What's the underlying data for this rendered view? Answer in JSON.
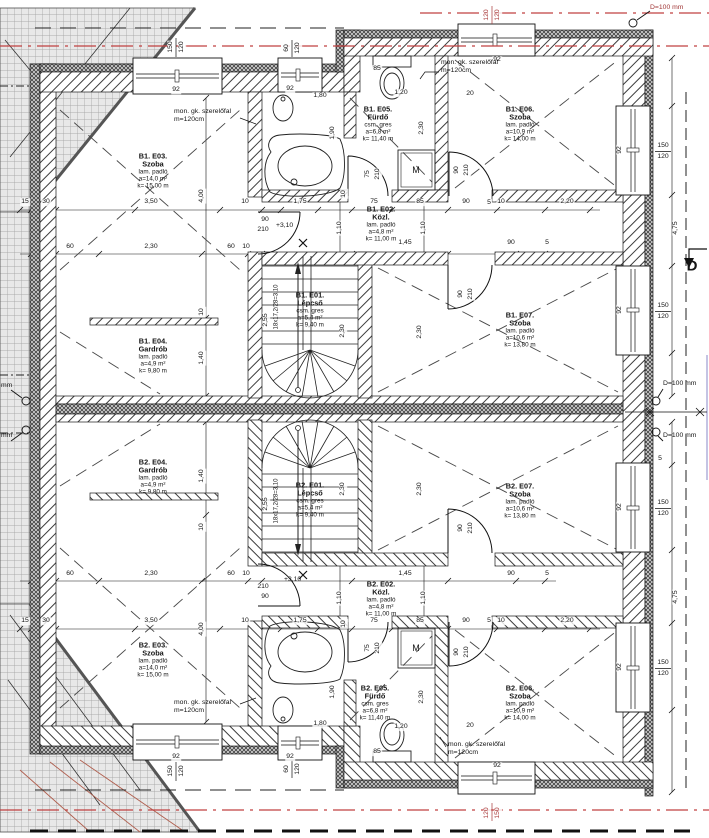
{
  "colors": {
    "red_line": "#c04040",
    "dim_red": "#a83838",
    "blue": "#8a8ac8",
    "ink": "#141414"
  },
  "rooms": [
    {
      "id": "b1-e03",
      "cx": 153,
      "cy": 171,
      "lines": [
        "B1. E03.",
        "Szoba",
        "lam. padló",
        "a=14,0 m²",
        "k= 15,00 m"
      ]
    },
    {
      "id": "b1-e04",
      "cx": 153,
      "cy": 356,
      "lines": [
        "B1. E04.",
        "Gardrób",
        "lam. padló",
        "a=4,9 m²",
        "k= 9,80 m"
      ]
    },
    {
      "id": "b1-e05",
      "cx": 378,
      "cy": 124,
      "lines": [
        "B1. E05.",
        "Fürdő",
        "csm. gres",
        "a=6,8 m²",
        "k= 11,40 m"
      ]
    },
    {
      "id": "b1-e06",
      "cx": 520,
      "cy": 124,
      "lines": [
        "B1. E06.",
        "Szoba",
        "lam. padló",
        "a=10,9 m²",
        "k= 14,00 m"
      ]
    },
    {
      "id": "b1-e02",
      "cx": 381,
      "cy": 224,
      "lines": [
        "B1. E02.",
        "Közl.",
        "lam. padló",
        "a=4,8 m²",
        "k= 11,00 m"
      ]
    },
    {
      "id": "b1-e01",
      "cx": 310,
      "cy": 310,
      "lines": [
        "B1. E01.",
        "Lépcső",
        "csm. gres",
        "a=5,4 m²",
        "k= 9,40 m"
      ]
    },
    {
      "id": "b1-e07",
      "cx": 520,
      "cy": 330,
      "lines": [
        "B1. E07.",
        "Szoba",
        "lam. padló",
        "a=10,6 m²",
        "k= 13,80 m"
      ]
    },
    {
      "id": "b2-e04",
      "cx": 153,
      "cy": 477,
      "lines": [
        "B2. E04.",
        "Gardrób",
        "lam. padló",
        "a=4,9 m²",
        "k= 9,80 m"
      ]
    },
    {
      "id": "b2-e01",
      "cx": 310,
      "cy": 500,
      "lines": [
        "B2. E01.",
        "Lépcső",
        "csm. gres",
        "a=5,4 m²",
        "k= 9,40 m"
      ]
    },
    {
      "id": "b2-e02",
      "cx": 381,
      "cy": 599,
      "lines": [
        "B2. E02.",
        "Közl.",
        "lam. padló",
        "a=4,8 m²",
        "k= 11,00 m"
      ]
    },
    {
      "id": "b2-e07",
      "cx": 520,
      "cy": 501,
      "lines": [
        "B2. E07.",
        "Szoba",
        "lam. padló",
        "a=10,6 m²",
        "k= 13,80 m"
      ]
    },
    {
      "id": "b2-e03",
      "cx": 153,
      "cy": 660,
      "lines": [
        "B2. E03.",
        "Szoba",
        "lam. padló",
        "a=14,0 m²",
        "k= 15,00 m"
      ]
    },
    {
      "id": "b2-e05",
      "cx": 375,
      "cy": 703,
      "lines": [
        "B2. E05.",
        "Fürdő",
        "csm. gres",
        "a=6,8 m²",
        "k= 11,40 m"
      ]
    },
    {
      "id": "b2-e06",
      "cx": 520,
      "cy": 703,
      "lines": [
        "B2. E06.",
        "Szoba",
        "lam. padló",
        "a=10,9 m²",
        "k= 14,00 m"
      ]
    }
  ],
  "notes": [
    {
      "id": "szerelofal-1",
      "x": 174,
      "y": 108,
      "lines": [
        "mon. gk. szerelőfal",
        "m=120cm"
      ]
    },
    {
      "id": "szerelofal-2",
      "x": 441,
      "y": 59,
      "lines": [
        "mon. gk. szerelőfal",
        "m=120cm"
      ]
    },
    {
      "id": "szerelofal-3",
      "x": 174,
      "y": 699,
      "lines": [
        "mon. gk. szerelőfal",
        "m=120cm"
      ]
    },
    {
      "id": "szerelofal-4",
      "x": 448,
      "y": 741,
      "lines": [
        "mon. gk. szerelőfal",
        "m=120cm"
      ]
    },
    {
      "id": "d100-top",
      "x": 650,
      "y": 4,
      "color": "#a03636",
      "lines": [
        "D=100 mm"
      ]
    },
    {
      "id": "d100-right-1",
      "x": 663,
      "y": 380,
      "lines": [
        "D=100 mm"
      ]
    },
    {
      "id": "d100-right-2",
      "x": 663,
      "y": 432,
      "lines": [
        "D=100 mm"
      ]
    },
    {
      "id": "d100-left-1",
      "x": 1,
      "y": 382,
      "lines": [
        "mm"
      ]
    },
    {
      "id": "d100-left-2",
      "x": 1,
      "y": 432,
      "lines": [
        "mm"
      ]
    },
    {
      "id": "level-upper",
      "x": 276,
      "y": 222,
      "lines": [
        "+3,10"
      ]
    },
    {
      "id": "level-lower",
      "x": 284,
      "y": 576,
      "lines": [
        "+3,10"
      ]
    },
    {
      "id": "stair-run-upper",
      "x": 277,
      "y": 307,
      "rot": -90,
      "fs": 6,
      "align": "center",
      "lines": [
        "18x17,2/28=3,10"
      ]
    },
    {
      "id": "stair-run-lower",
      "x": 277,
      "y": 501,
      "rot": -90,
      "fs": 6,
      "align": "center",
      "lines": [
        "18x17,2/28=3,10"
      ]
    },
    {
      "id": "section-marker-d",
      "x": 692,
      "y": 267,
      "fs": 15,
      "bold": true,
      "align": "center",
      "lines": [
        "D"
      ]
    },
    {
      "id": "washing-machine-upper",
      "x": 416,
      "y": 170,
      "fs": 9,
      "align": "center",
      "lines": [
        "M"
      ]
    },
    {
      "id": "washing-machine-lower",
      "x": 416,
      "y": 648,
      "fs": 9,
      "align": "center",
      "lines": [
        "M"
      ]
    }
  ],
  "dims": [
    {
      "t": "92",
      "x": 176,
      "y": 90
    },
    {
      "t": "150",
      "x": 171,
      "y": 47,
      "r": 1
    },
    {
      "t": "120",
      "x": 182,
      "y": 47,
      "r": 1
    },
    {
      "t": "92",
      "x": 290,
      "y": 89
    },
    {
      "t": "60",
      "x": 287,
      "y": 48,
      "r": 1
    },
    {
      "t": "120",
      "x": 298,
      "y": 48,
      "r": 1
    },
    {
      "t": "92",
      "x": 497,
      "y": 60
    },
    {
      "t": "120",
      "x": 487,
      "y": 15,
      "r": 1,
      "c": 1
    },
    {
      "t": "120",
      "x": 498,
      "y": 15,
      "r": 1,
      "c": 1
    },
    {
      "t": "92",
      "x": 620,
      "y": 150,
      "r": 1
    },
    {
      "t": "150",
      "x": 663,
      "y": 146
    },
    {
      "t": "120",
      "x": 663,
      "y": 157
    },
    {
      "t": "92",
      "x": 620,
      "y": 310,
      "r": 1
    },
    {
      "t": "150",
      "x": 663,
      "y": 306
    },
    {
      "t": "120",
      "x": 663,
      "y": 317
    },
    {
      "t": "15",
      "x": 25,
      "y": 202
    },
    {
      "t": "30",
      "x": 46,
      "y": 202
    },
    {
      "t": "3,50",
      "x": 151,
      "y": 202
    },
    {
      "t": "10",
      "x": 245,
      "y": 202
    },
    {
      "t": "1,75",
      "x": 300,
      "y": 202
    },
    {
      "t": "75",
      "x": 374,
      "y": 202
    },
    {
      "t": "85",
      "x": 420,
      "y": 202
    },
    {
      "t": "90",
      "x": 466,
      "y": 202
    },
    {
      "t": "5",
      "x": 489,
      "y": 203
    },
    {
      "t": "10",
      "x": 501,
      "y": 202
    },
    {
      "t": "2,20",
      "x": 567,
      "y": 202
    },
    {
      "t": "60",
      "x": 70,
      "y": 247
    },
    {
      "t": "2,30",
      "x": 151,
      "y": 247
    },
    {
      "t": "60",
      "x": 231,
      "y": 247
    },
    {
      "t": "10",
      "x": 246,
      "y": 247
    },
    {
      "t": "1,45",
      "x": 405,
      "y": 243
    },
    {
      "t": "90",
      "x": 511,
      "y": 243
    },
    {
      "t": "5",
      "x": 547,
      "y": 243
    },
    {
      "t": "90",
      "x": 265,
      "y": 220
    },
    {
      "t": "210",
      "x": 263,
      "y": 230
    },
    {
      "t": "4,00",
      "x": 202,
      "y": 196,
      "r": 1
    },
    {
      "t": "1,40",
      "x": 202,
      "y": 358,
      "r": 1
    },
    {
      "t": "10",
      "x": 202,
      "y": 312,
      "r": 1
    },
    {
      "t": "2,55",
      "x": 266,
      "y": 320,
      "r": 1
    },
    {
      "t": "2,30",
      "x": 343,
      "y": 331,
      "r": 1
    },
    {
      "t": "2,30",
      "x": 422,
      "y": 128,
      "r": 1
    },
    {
      "t": "1,90",
      "x": 333,
      "y": 133,
      "r": 1
    },
    {
      "t": "1,10",
      "x": 340,
      "y": 228,
      "r": 1
    },
    {
      "t": "1,10",
      "x": 424,
      "y": 228,
      "r": 1
    },
    {
      "t": "2,30",
      "x": 420,
      "y": 332,
      "r": 1
    },
    {
      "t": "4,75",
      "x": 676,
      "y": 228,
      "r": 1
    },
    {
      "t": "75",
      "x": 368,
      "y": 174,
      "r": 1
    },
    {
      "t": "210",
      "x": 378,
      "y": 174,
      "r": 1
    },
    {
      "t": "90",
      "x": 457,
      "y": 170,
      "r": 1
    },
    {
      "t": "210",
      "x": 467,
      "y": 170,
      "r": 1
    },
    {
      "t": "90",
      "x": 461,
      "y": 294,
      "r": 1
    },
    {
      "t": "210",
      "x": 471,
      "y": 294,
      "r": 1
    },
    {
      "t": "85",
      "x": 377,
      "y": 69
    },
    {
      "t": "1,20",
      "x": 401,
      "y": 93
    },
    {
      "t": "1,80",
      "x": 320,
      "y": 96
    },
    {
      "t": "20",
      "x": 470,
      "y": 94
    },
    {
      "t": "10",
      "x": 344,
      "y": 194,
      "r": 1
    },
    {
      "t": "60",
      "x": 70,
      "y": 574
    },
    {
      "t": "2,30",
      "x": 151,
      "y": 574
    },
    {
      "t": "60",
      "x": 231,
      "y": 574
    },
    {
      "t": "10",
      "x": 246,
      "y": 574
    },
    {
      "t": "1,45",
      "x": 405,
      "y": 574
    },
    {
      "t": "90",
      "x": 511,
      "y": 574
    },
    {
      "t": "5",
      "x": 547,
      "y": 574
    },
    {
      "t": "15",
      "x": 25,
      "y": 621
    },
    {
      "t": "30",
      "x": 46,
      "y": 621
    },
    {
      "t": "3,50",
      "x": 151,
      "y": 621
    },
    {
      "t": "10",
      "x": 245,
      "y": 621
    },
    {
      "t": "1,75",
      "x": 300,
      "y": 621
    },
    {
      "t": "75",
      "x": 374,
      "y": 621
    },
    {
      "t": "85",
      "x": 420,
      "y": 621
    },
    {
      "t": "90",
      "x": 466,
      "y": 621
    },
    {
      "t": "5",
      "x": 489,
      "y": 621
    },
    {
      "t": "10",
      "x": 501,
      "y": 621
    },
    {
      "t": "2,20",
      "x": 567,
      "y": 621
    },
    {
      "t": "90",
      "x": 265,
      "y": 597
    },
    {
      "t": "210",
      "x": 263,
      "y": 587
    },
    {
      "t": "4,00",
      "x": 202,
      "y": 629,
      "r": 1
    },
    {
      "t": "1,40",
      "x": 202,
      "y": 476,
      "r": 1
    },
    {
      "t": "10",
      "x": 202,
      "y": 527,
      "r": 1
    },
    {
      "t": "2,55",
      "x": 266,
      "y": 504,
      "r": 1
    },
    {
      "t": "2,30",
      "x": 343,
      "y": 489,
      "r": 1
    },
    {
      "t": "2,30",
      "x": 422,
      "y": 697,
      "r": 1
    },
    {
      "t": "1,90",
      "x": 333,
      "y": 692,
      "r": 1
    },
    {
      "t": "1,10",
      "x": 340,
      "y": 598,
      "r": 1
    },
    {
      "t": "1,10",
      "x": 424,
      "y": 598,
      "r": 1
    },
    {
      "t": "2,30",
      "x": 420,
      "y": 489,
      "r": 1
    },
    {
      "t": "4,75",
      "x": 676,
      "y": 597,
      "r": 1
    },
    {
      "t": "75",
      "x": 368,
      "y": 648,
      "r": 1
    },
    {
      "t": "210",
      "x": 378,
      "y": 648,
      "r": 1
    },
    {
      "t": "90",
      "x": 457,
      "y": 652,
      "r": 1
    },
    {
      "t": "210",
      "x": 467,
      "y": 652,
      "r": 1
    },
    {
      "t": "90",
      "x": 461,
      "y": 528,
      "r": 1
    },
    {
      "t": "210",
      "x": 471,
      "y": 528,
      "r": 1
    },
    {
      "t": "85",
      "x": 377,
      "y": 752
    },
    {
      "t": "1,20",
      "x": 401,
      "y": 727
    },
    {
      "t": "1,80",
      "x": 320,
      "y": 724
    },
    {
      "t": "20",
      "x": 470,
      "y": 726
    },
    {
      "t": "10",
      "x": 344,
      "y": 624,
      "r": 1
    },
    {
      "t": "92",
      "x": 176,
      "y": 757
    },
    {
      "t": "150",
      "x": 171,
      "y": 771,
      "r": 1
    },
    {
      "t": "120",
      "x": 182,
      "y": 771,
      "r": 1
    },
    {
      "t": "92",
      "x": 290,
      "y": 757
    },
    {
      "t": "60",
      "x": 287,
      "y": 769,
      "r": 1
    },
    {
      "t": "120",
      "x": 298,
      "y": 769,
      "r": 1
    },
    {
      "t": "92",
      "x": 497,
      "y": 766
    },
    {
      "t": "120",
      "x": 487,
      "y": 813,
      "r": 1,
      "c": 1
    },
    {
      "t": "150",
      "x": 498,
      "y": 813,
      "r": 1,
      "c": 1
    },
    {
      "t": "92",
      "x": 620,
      "y": 507,
      "r": 1
    },
    {
      "t": "150",
      "x": 663,
      "y": 503
    },
    {
      "t": "120",
      "x": 663,
      "y": 514
    },
    {
      "t": "92",
      "x": 620,
      "y": 667,
      "r": 1
    },
    {
      "t": "150",
      "x": 663,
      "y": 663
    },
    {
      "t": "120",
      "x": 663,
      "y": 674
    },
    {
      "t": "5",
      "x": 660,
      "y": 459
    }
  ]
}
